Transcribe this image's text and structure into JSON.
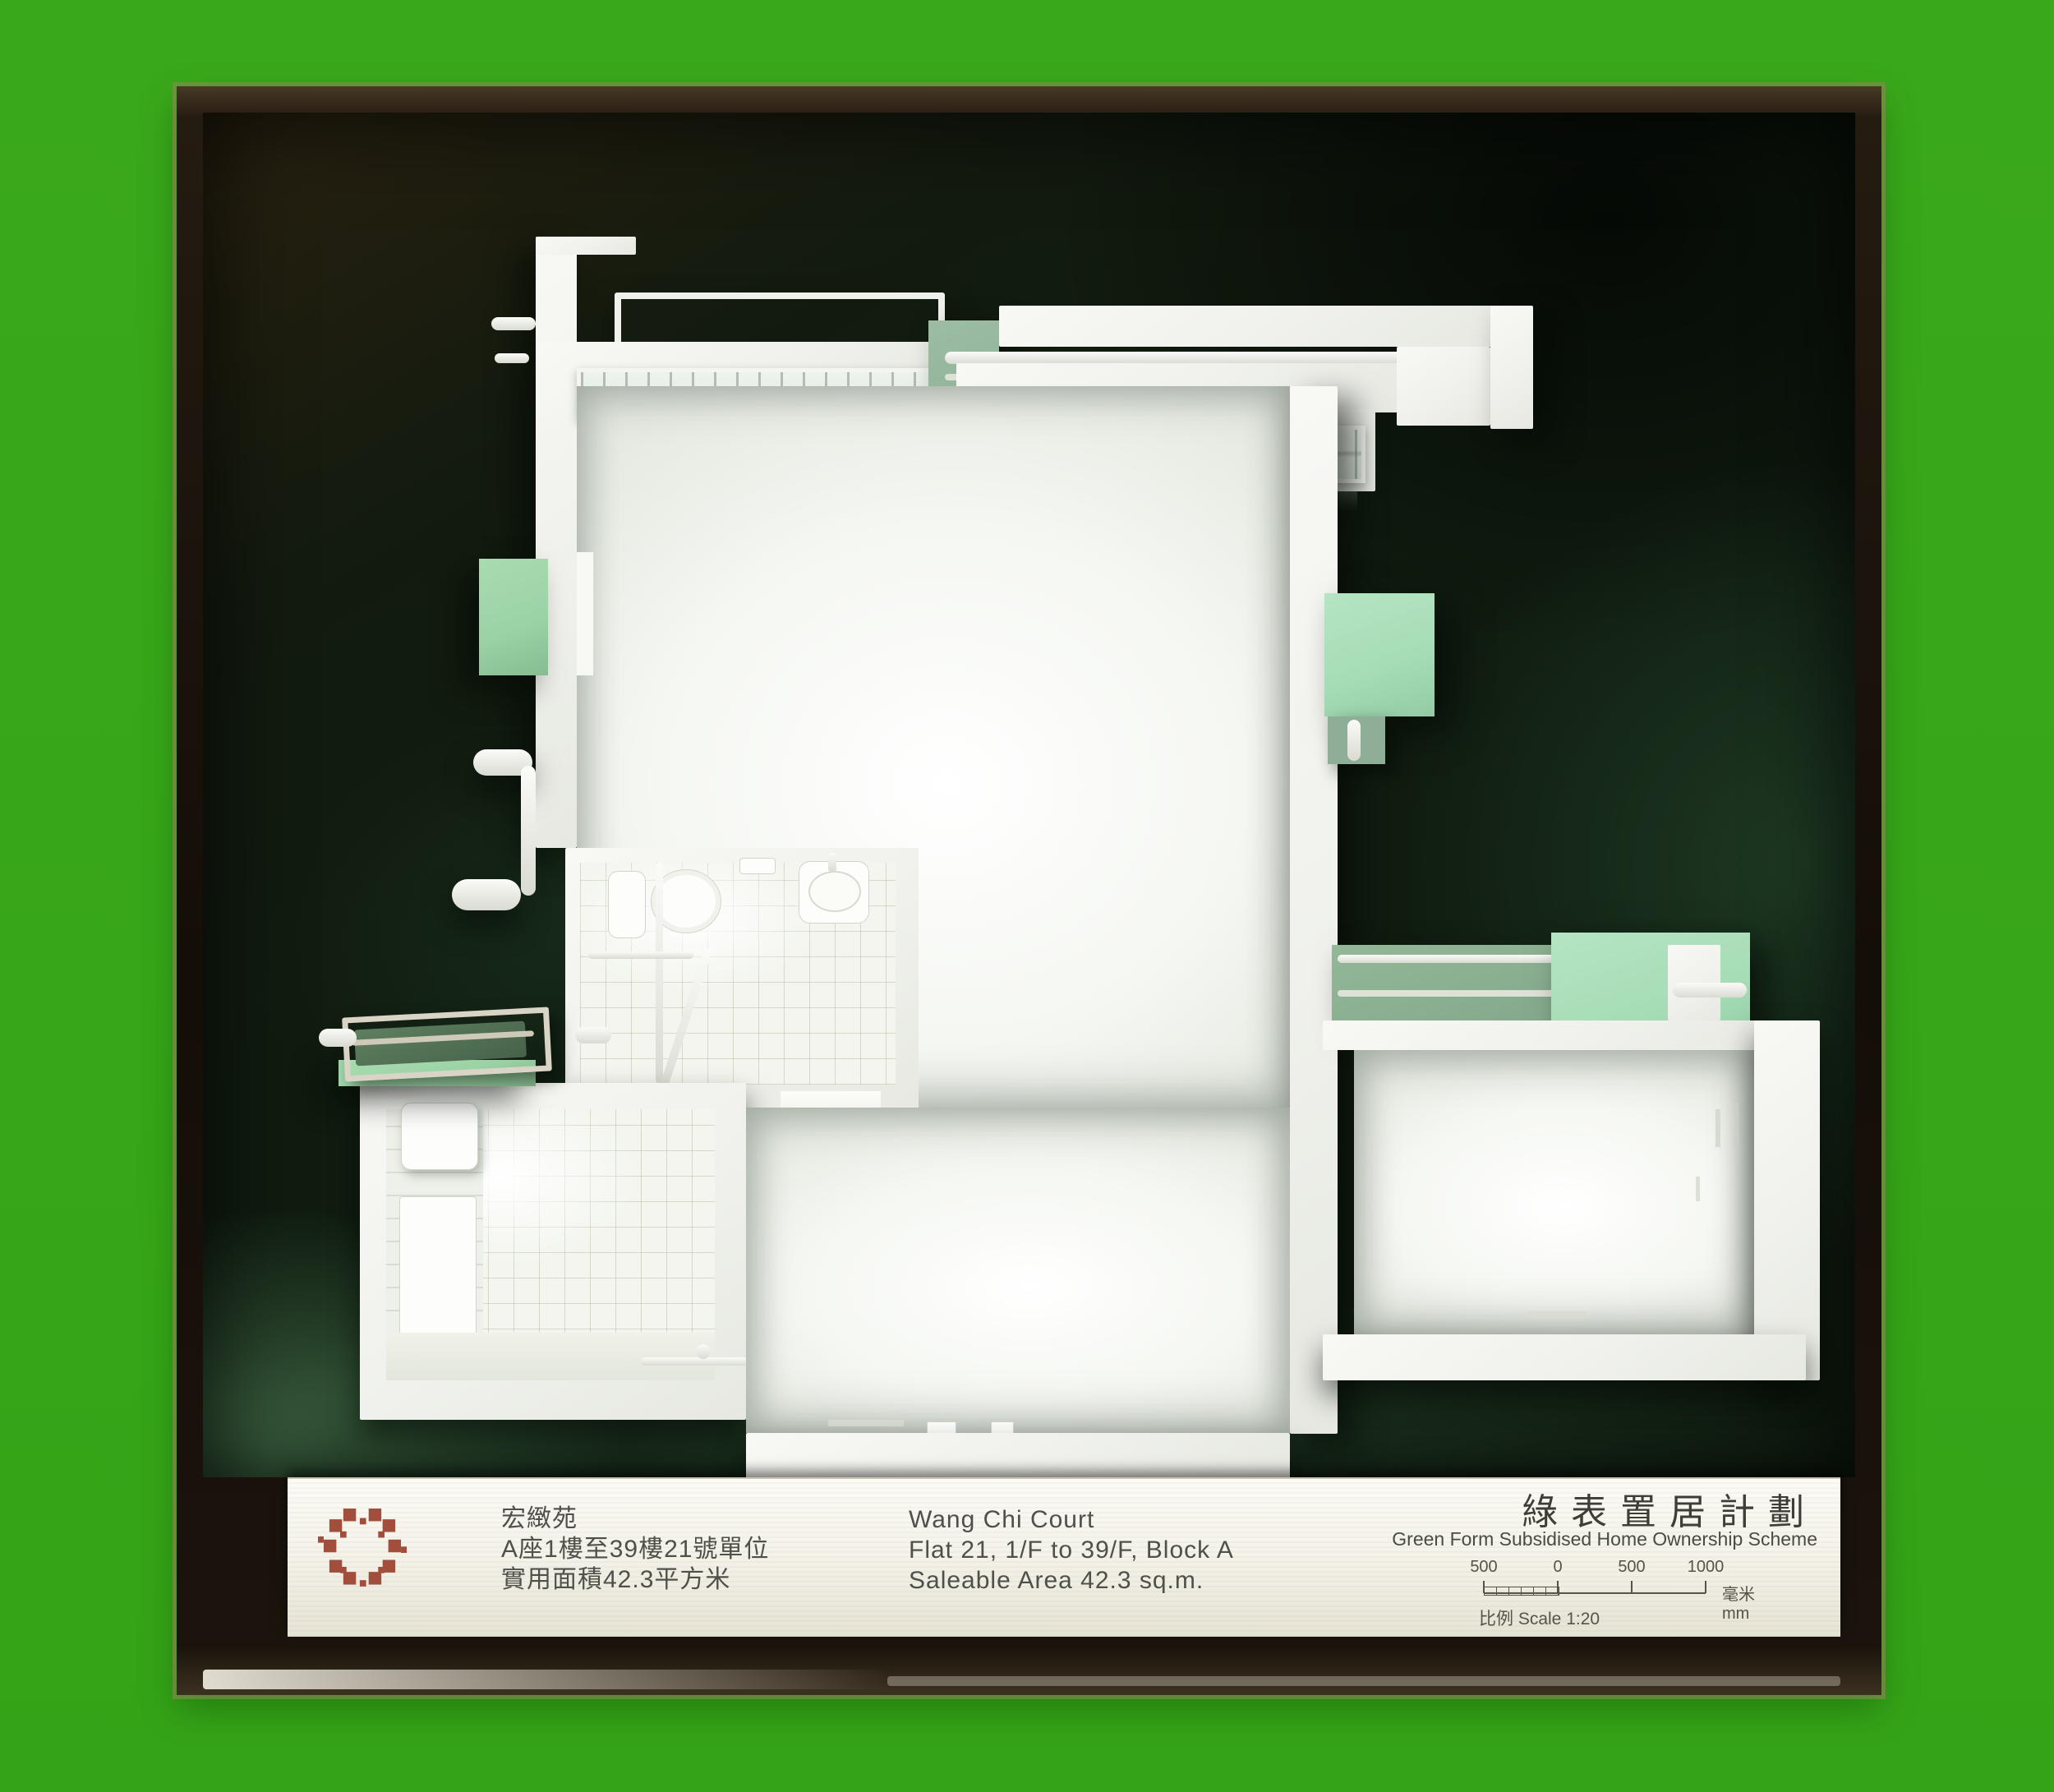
{
  "colors": {
    "background_green": "#38a719",
    "case_frame_dark": "#17100a",
    "backdrop_dark_green": "#101c10",
    "model_white": "#f3f4f0",
    "mint_panel_green": "#a5dcb5",
    "balcony_sage_green": "#9bd2a4",
    "logo_red": "#a24e3c",
    "plaque_offwhite": "#f6f4ec"
  },
  "plaque": {
    "logo_icon": "housing-authority-pixel-ring-logo",
    "chinese": {
      "estate_name": "宏緻苑",
      "unit_line": "A座1樓至39樓21號單位",
      "area_line": "實用面積42.3平方米"
    },
    "english": {
      "estate_name": "Wang Chi Court",
      "unit_line": "Flat 21, 1/F to 39/F, Block A",
      "area_line": "Saleable Area 42.3 sq.m."
    },
    "scheme": {
      "chinese": "綠表置居計劃",
      "english": "Green Form Subsidised Home Ownership Scheme"
    },
    "scale_bar": {
      "labels": [
        "500",
        "0",
        "500",
        "1000"
      ],
      "unit_label": "毫米mm",
      "ratio_label": "比例 Scale 1:20"
    }
  }
}
